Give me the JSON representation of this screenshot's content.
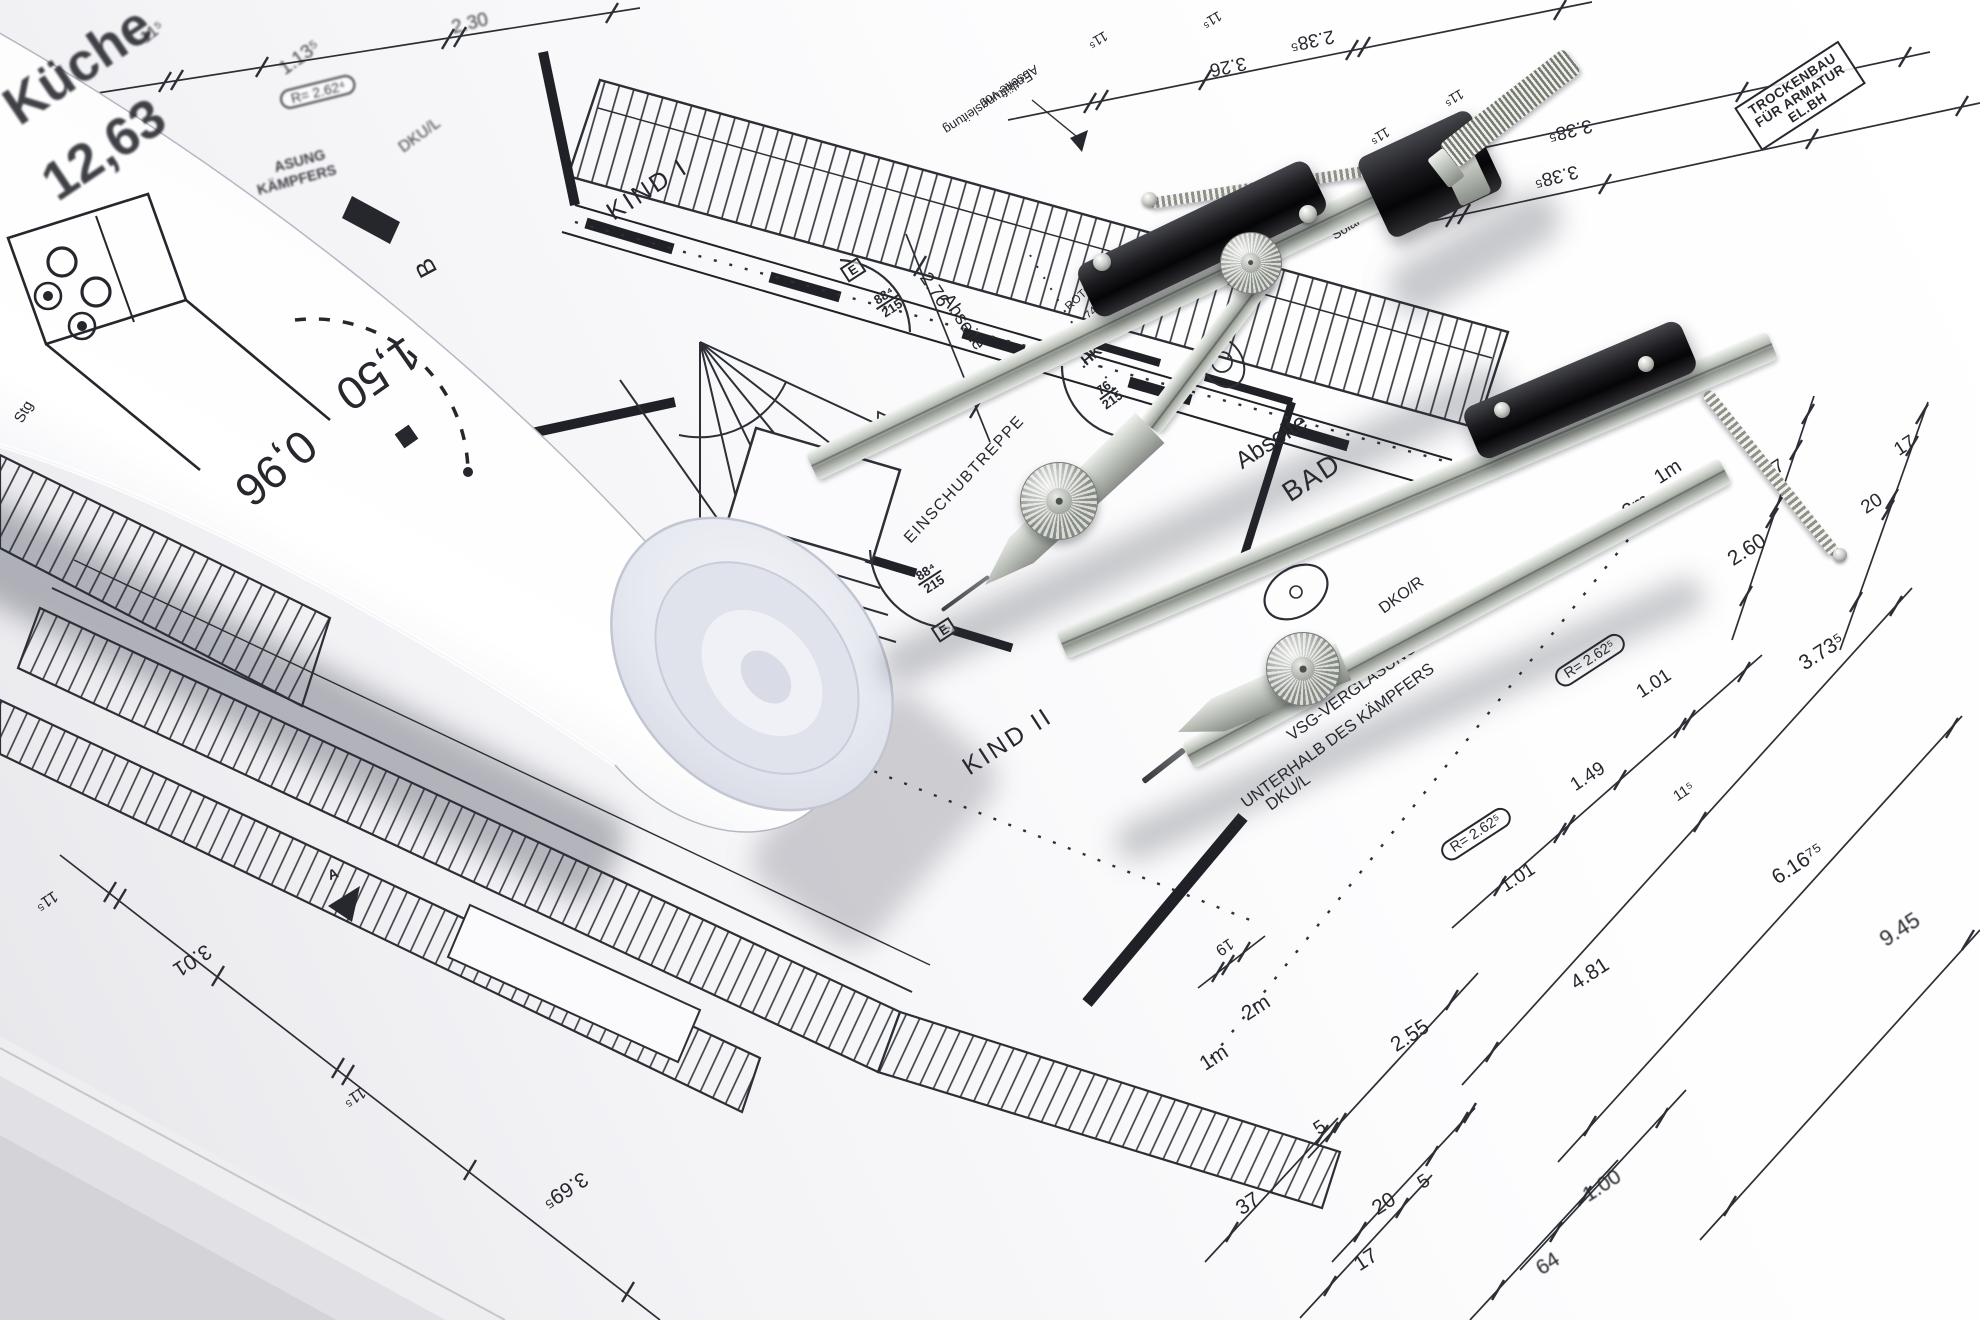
{
  "colors": {
    "ink": "#26282e",
    "paper": "#fafafc",
    "backdrop": "#d4d4d8",
    "compass_metal": "#b8bdb6",
    "compass_grip": "#141417",
    "roll_shading": "#dfe2ea"
  },
  "labels": {
    "kueche": "Küche",
    "kueche_area": "12,63",
    "kind1": "KIND I",
    "kind2": "KIND II",
    "bad": "BAD",
    "abseite_stairs": "Abseite",
    "abseite_bad": "Abseite",
    "abseite_vor_l1": "Abseite vor",
    "abseite_vor_l2": "Entlüftungsleitung",
    "einschubtreppe": "EINSCHUBTREPPE",
    "dkul_top": "DKU/L",
    "dkul_bottom": "DKU/L",
    "dkor": "DKO/R",
    "klar_gl": "KLAR GL.",
    "vsg_l1": "VSG-VERGLASUNG",
    "vsg_l2": "UNTERHALB DES KÄMPFERS",
    "trockenbau_l1": "TROCKENBAU",
    "trockenbau_l2": "FÜR ARMATUR",
    "trockenbau_l3": "EL.BH",
    "twin_tube_l1": "Twin-Tube",
    "twin_tube_l2": "Solar",
    "roto_l1": "ROTO",
    "roto_l2": "74",
    "roto_l3": "140",
    "hkv": ".HKV",
    "stg": "Stg",
    "b_marker": "B",
    "a_marker": "A",
    "e_marker1": "E",
    "e_marker2": "E",
    "asung": "ASUNG",
    "kaempfers": "KÄMPFERS"
  },
  "fractions": {
    "door1_num": "88⁴",
    "door1_den": "215",
    "door2_num": "88⁴",
    "door2_den": "215",
    "door3_num": "76",
    "door3_den": "215"
  },
  "radius_labels": {
    "r1": "R= 2.62⁴",
    "r2": "R= 2.62⁵",
    "r3": "R= 2.62⁵"
  },
  "dims": {
    "top": [
      "11⁵",
      "1.13⁵",
      "2.30"
    ],
    "upper_right": [
      "3.26",
      "2.38⁵",
      "3.38⁵",
      "3.38⁵",
      "11⁵",
      "11⁵",
      "11⁵",
      "11⁵"
    ],
    "right": [
      "37",
      "20",
      "17",
      "2.60"
    ],
    "lower_right": [
      "1.01",
      "1.49",
      "11⁵",
      "1.01",
      "4.81",
      "3.73⁵",
      "6.16⁷⁵",
      "9.45",
      "2.55",
      "5",
      "37",
      "20",
      "5",
      "17",
      "64",
      "1.00",
      "19"
    ],
    "lower_left": [
      "11⁵",
      "3.01",
      "11⁵",
      "3.69⁵"
    ],
    "vertical": [
      "2.76"
    ],
    "scale": [
      "1m",
      "2m",
      "1m",
      "2m"
    ]
  },
  "roll_labels": {
    "dim_150": "1,50",
    "dim_096": "0,96"
  }
}
